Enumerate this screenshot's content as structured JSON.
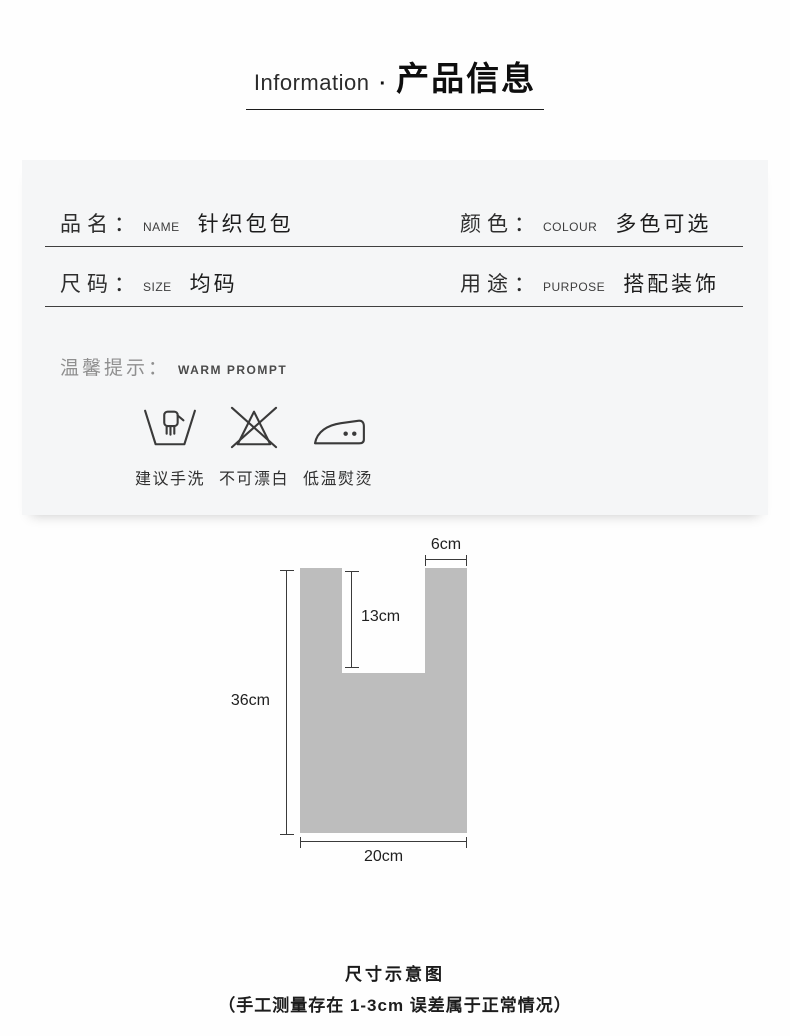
{
  "header": {
    "title_en": "Information",
    "separator": "·",
    "title_cn": "产品信息"
  },
  "specs": {
    "rows": [
      {
        "cells": [
          {
            "label_cn": "品名：",
            "label_en": "NAME",
            "value": "针织包包"
          },
          {
            "label_cn": "颜色：",
            "label_en": "COLOUR",
            "value": "多色可选"
          }
        ]
      },
      {
        "cells": [
          {
            "label_cn": "尺码：",
            "label_en": "SIZE",
            "value": "均码"
          },
          {
            "label_cn": "用途：",
            "label_en": "PURPOSE",
            "value": "搭配装饰"
          }
        ]
      }
    ]
  },
  "prompt": {
    "label_cn": "温馨提示：",
    "label_en": "WARM PROMPT"
  },
  "care_icons": [
    {
      "icon": "hand-wash-icon",
      "label": "建议手洗"
    },
    {
      "icon": "do-not-bleach-icon",
      "label": "不可漂白"
    },
    {
      "icon": "iron-low-temp-icon",
      "label": "低温熨烫"
    }
  ],
  "diagram": {
    "bag_color": "#bdbdbd",
    "height_label": "36cm",
    "width_label": "20cm",
    "handle_depth_label": "13cm",
    "strap_width_label": "6cm"
  },
  "footer": {
    "title": "尺寸示意图",
    "note": "（手工测量存在 1-3cm 误差属于正常情况）"
  }
}
